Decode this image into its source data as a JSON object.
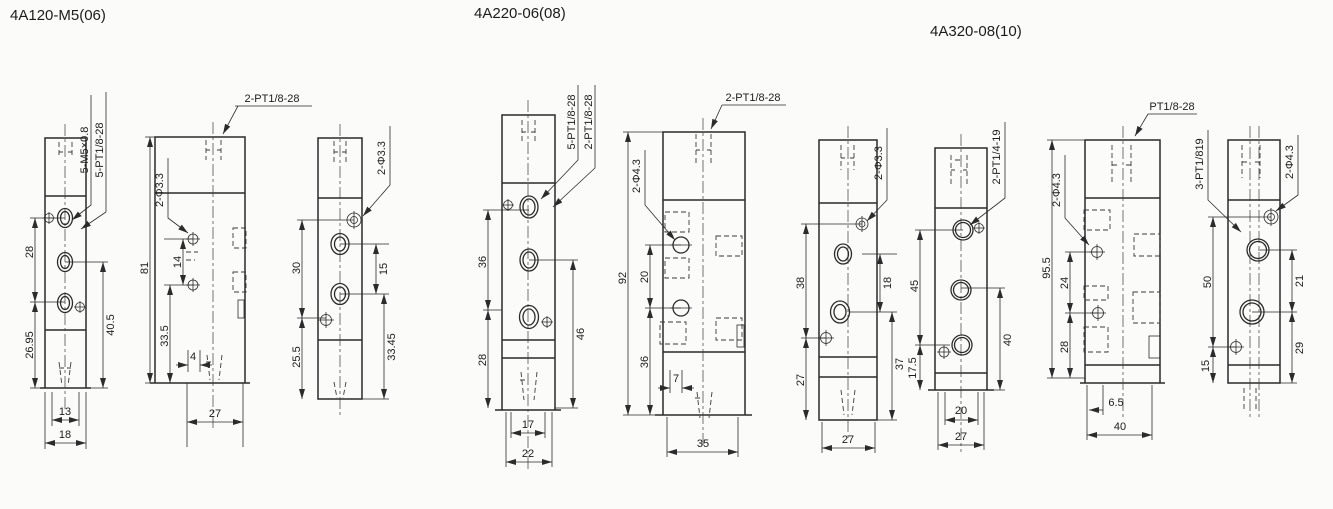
{
  "colors": {
    "ink": "#2b2b2b",
    "paper": "#fbfbf9"
  },
  "groups": [
    {
      "title": "4A120-M5(06)",
      "views": [
        {
          "name": "front-view",
          "ports": [
            "5-M5×0.8",
            "5-PT1/8-28"
          ],
          "dims": [
            "28",
            "26.95",
            "40.5",
            "13",
            "18"
          ]
        },
        {
          "name": "side-view",
          "ports": [
            "2-PT1/8-28",
            "2-Φ3.3"
          ],
          "dims": [
            "81",
            "14",
            "33.5",
            "4",
            "27"
          ]
        },
        {
          "name": "back-view",
          "ports": [
            "2-Φ3.3"
          ],
          "dims": [
            "30",
            "25.5",
            "15",
            "33.45"
          ]
        }
      ]
    },
    {
      "title": "4A220-06(08)",
      "views": [
        {
          "name": "front-view",
          "ports": [
            "5-PT1/8-28",
            "2-PT1/8-28"
          ],
          "dims": [
            "36",
            "28",
            "46",
            "17",
            "22"
          ]
        },
        {
          "name": "side-view",
          "ports": [
            "2-PT1/8-28",
            "2-Φ4.3"
          ],
          "dims": [
            "92",
            "20",
            "36",
            "7",
            "35"
          ]
        },
        {
          "name": "back-view",
          "ports": [
            "2-Φ3.3"
          ],
          "dims": [
            "38",
            "27",
            "18",
            "37",
            "27"
          ]
        }
      ]
    },
    {
      "title": "4A320-08(10)",
      "views": [
        {
          "name": "front-view",
          "ports": [
            "2-PT1/4-19"
          ],
          "dims": [
            "45",
            "17.5",
            "40",
            "20",
            "27"
          ]
        },
        {
          "name": "side-view",
          "ports": [
            "PT1/8-28",
            "2-Φ4.3"
          ],
          "dims": [
            "95.5",
            "24",
            "28",
            "6.5",
            "40"
          ]
        },
        {
          "name": "back-view",
          "ports": [
            "3-PT1/819",
            "2-Φ4.3"
          ],
          "dims": [
            "50",
            "15",
            "21",
            "29"
          ]
        }
      ]
    }
  ]
}
